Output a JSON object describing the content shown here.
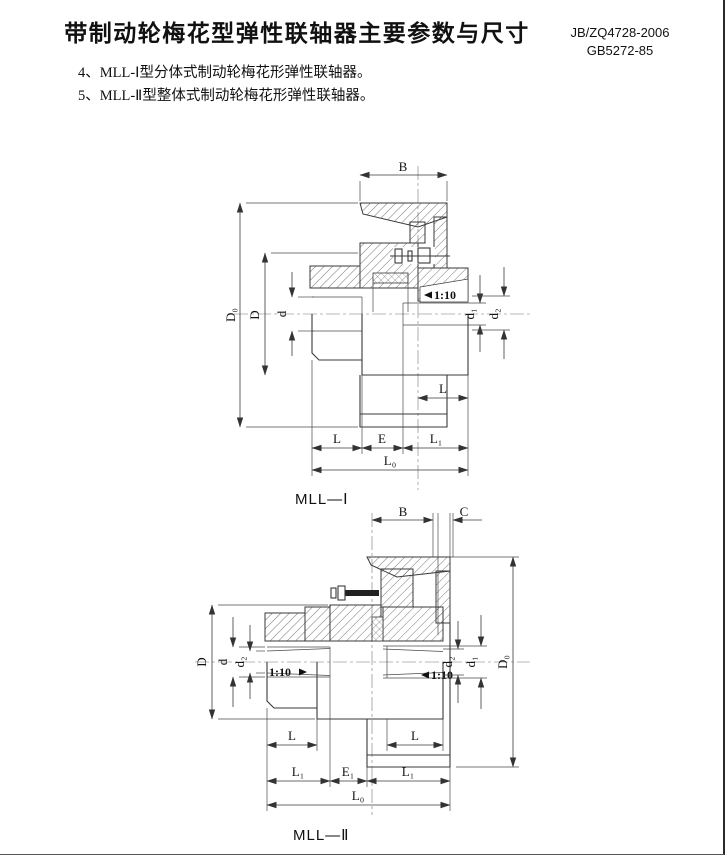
{
  "page": {
    "title": "带制动轮梅花型弹性联轴器主要参数与尺寸",
    "standard_line1": "JB/ZQ4728-2006",
    "standard_line2": "GB5272-85",
    "note4": "4、MLL-Ⅰ型分体式制动轮梅花形弹性联轴器。",
    "note5": "5、MLL-Ⅱ型整体式制动轮梅花形弹性联轴器。"
  },
  "figure1": {
    "caption": "MLL—Ⅰ",
    "labels": {
      "B": "B",
      "D0": "D₀",
      "D": "D",
      "d": "d",
      "taper_right": "1:10",
      "d1": "d₁",
      "d2": "d₂",
      "L_hub_right": "L",
      "L": "L",
      "E": "E",
      "L1": "L₁",
      "L0": "L₀"
    }
  },
  "figure2": {
    "caption": "MLL—Ⅱ",
    "labels": {
      "B": "B",
      "C": "C",
      "D": "D",
      "d": "d",
      "d2_left": "d₂",
      "taper_left": "1:10",
      "taper_right": "1:10",
      "d2_right": "d₂",
      "d1": "d₁",
      "D0": "D₀",
      "L_left": "L",
      "L_right": "L",
      "L1_left": "L₁",
      "E1": "E₁",
      "L1_right": "L₁",
      "L0": "L₀"
    }
  }
}
